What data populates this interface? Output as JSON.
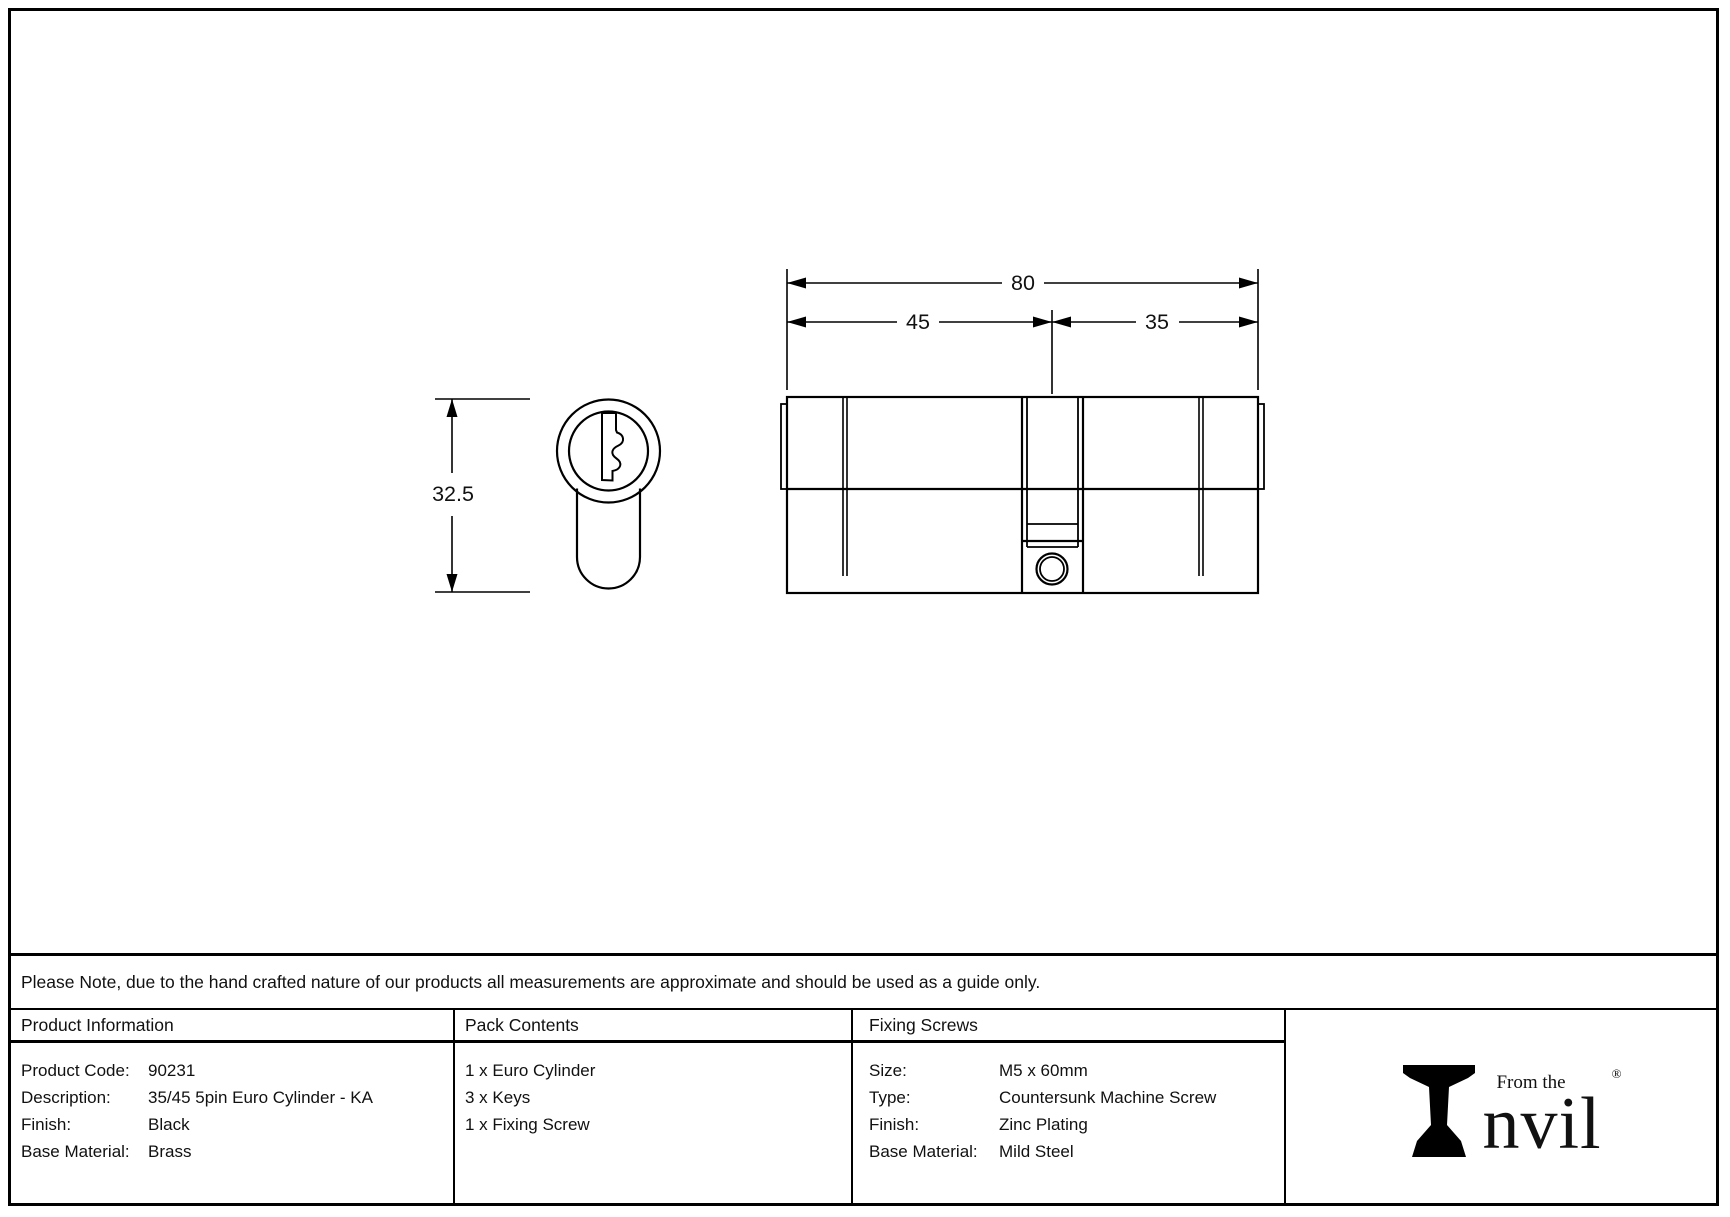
{
  "drawing": {
    "dim_total": "80",
    "dim_left": "45",
    "dim_right": "35",
    "dim_height": "32.5"
  },
  "note_text": "Please Note, due to the hand crafted nature of our products all measurements are approximate and should be used as a guide only.",
  "product_info": {
    "header": "Product Information",
    "rows": [
      {
        "label": "Product Code:",
        "value": "90231"
      },
      {
        "label": "Description:",
        "value": "35/45 5pin Euro Cylinder - KA"
      },
      {
        "label": "Finish:",
        "value": "Black"
      },
      {
        "label": "Base Material:",
        "value": "Brass"
      }
    ]
  },
  "pack_contents": {
    "header": "Pack Contents",
    "items": [
      "1 x Euro Cylinder",
      "3 x Keys",
      "1 x Fixing Screw"
    ]
  },
  "fixing_screws": {
    "header": "Fixing Screws",
    "rows": [
      {
        "label": "Size:",
        "value": "M5 x 60mm"
      },
      {
        "label": "Type:",
        "value": "Countersunk Machine Screw"
      },
      {
        "label": "Finish:",
        "value": "Zinc Plating"
      },
      {
        "label": "Base Material:",
        "value": "Mild Steel"
      }
    ]
  },
  "logo": {
    "prefix": "From the",
    "brand_rest": "nvil",
    "registered_mark": "®"
  },
  "colors": {
    "line": "#000000",
    "text": "#111111",
    "background": "#ffffff"
  }
}
